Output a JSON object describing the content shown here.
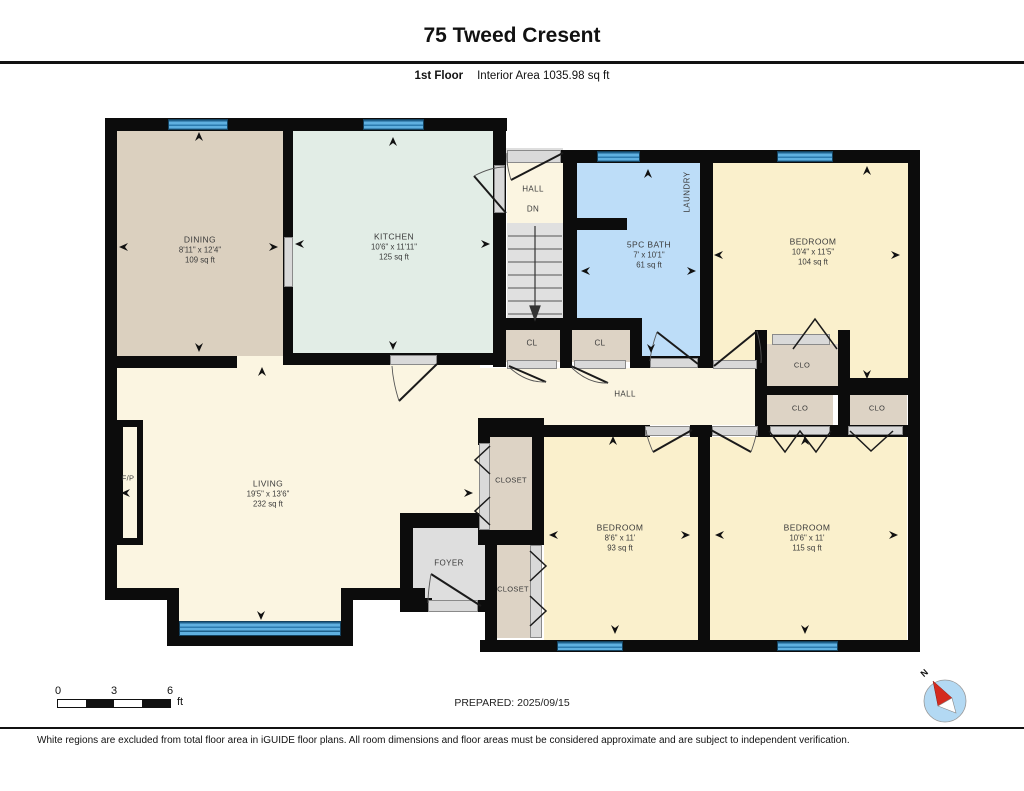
{
  "header": {
    "title": "75 Tweed Cresent",
    "floor_label": "1st Floor",
    "area_label": "Interior Area 1035.98 sq ft"
  },
  "rooms": {
    "dining": {
      "name": "DINING",
      "dims": "8'11\" x 12'4\"",
      "area": "109 sq ft"
    },
    "kitchen": {
      "name": "KITCHEN",
      "dims": "10'6\" x 11'11\"",
      "area": "125 sq ft"
    },
    "stair_hall": {
      "name": "HALL",
      "down_label": "DN"
    },
    "bath": {
      "name": "5PC BATH",
      "dims": "7' x 10'1\"",
      "area": "61 sq ft"
    },
    "laundry": {
      "name": "LAUNDRY"
    },
    "bedroom_ne": {
      "name": "BEDROOM",
      "dims": "10'4\" x 11'5\"",
      "area": "104 sq ft"
    },
    "hall": {
      "name": "HALL"
    },
    "living": {
      "name": "LIVING",
      "dims": "19'5\" x 13'6\"",
      "area": "232 sq ft"
    },
    "fireplace": {
      "name": "F/P"
    },
    "foyer": {
      "name": "FOYER"
    },
    "bedroom_s1": {
      "name": "BEDROOM",
      "dims": "8'6\" x 11'",
      "area": "93 sq ft"
    },
    "bedroom_s2": {
      "name": "BEDROOM",
      "dims": "10'6\" x 11'",
      "area": "115 sq ft"
    }
  },
  "closets": {
    "cl1": "CL",
    "cl2": "CL",
    "clo1": "CLO",
    "clo2": "CLO",
    "clo3": "CLO",
    "closet_upper": "CLOSET",
    "closet_lower": "CLOSET"
  },
  "scale_bar": {
    "ticks": [
      "0",
      "3",
      "6"
    ],
    "unit": "ft"
  },
  "prepared_label": "PREPARED: 2025/09/15",
  "compass": {
    "north_label": "N"
  },
  "footer": {
    "disclaimer": "White regions are excluded from total floor area in iGUIDE floor plans. All room dimensions and floor areas must be considered approximate and are subject to independent verification."
  },
  "colors": {
    "dining": "#dbd0bf",
    "kitchen": "#e2ede6",
    "bath": "#bdddf8",
    "bedroom": "#faf0cc",
    "living": "#fbf5e1",
    "closet": "#ddd3c5",
    "gray_area": "#dedede",
    "window": "#5fb0e0",
    "wall": "#0c0c0c"
  }
}
